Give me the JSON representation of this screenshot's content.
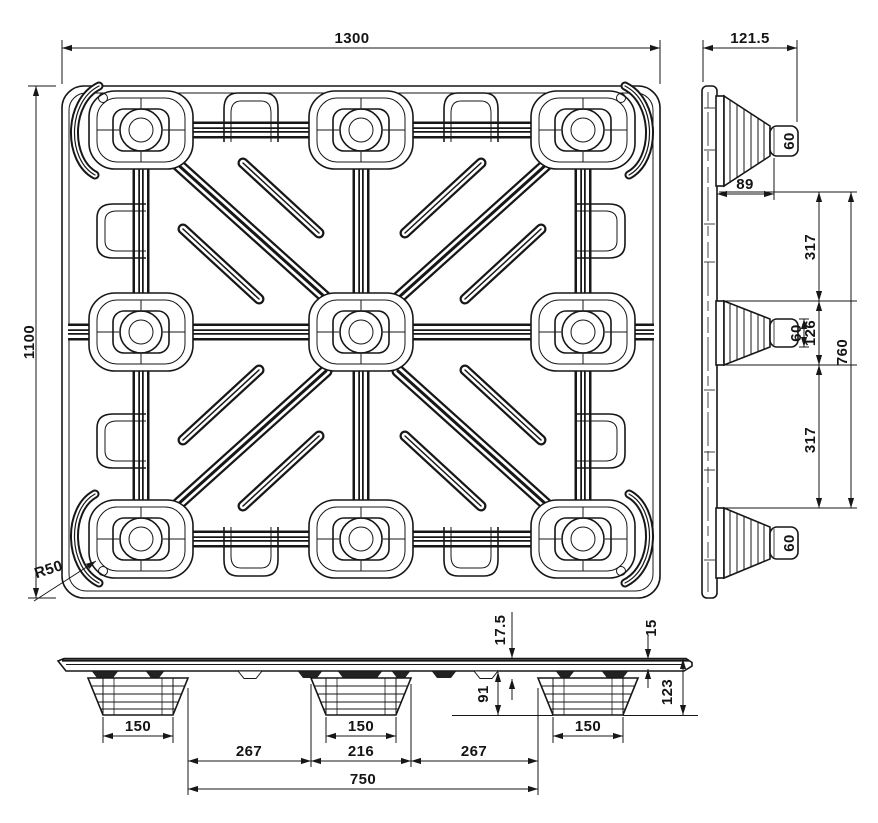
{
  "drawing": {
    "type": "technical-drawing",
    "subject": "plastic pallet - three orthographic views",
    "ink_color": "#171717",
    "paper_color": "#ffffff"
  },
  "dims": {
    "top": {
      "width": "1300",
      "depth": "1100",
      "corner_radius": "R50"
    },
    "side": {
      "overall_width": "121.5",
      "top_foot_tip": "60",
      "mid_foot_tip": "60",
      "bottom_foot_tip": "60",
      "foot_inset": "89",
      "upper_gap": "317",
      "mid_foot_base": "126",
      "lower_gap": "317",
      "feet_span": "760"
    },
    "front": {
      "deck_thickness": "17.5",
      "edge_thickness": "15",
      "clearance": "91",
      "overall_height": "123",
      "left_foot_base": "150",
      "center_foot_base": "150",
      "right_foot_base": "150",
      "left_gap": "267",
      "center_foot_top": "216",
      "right_gap": "267",
      "feet_span": "750"
    }
  }
}
